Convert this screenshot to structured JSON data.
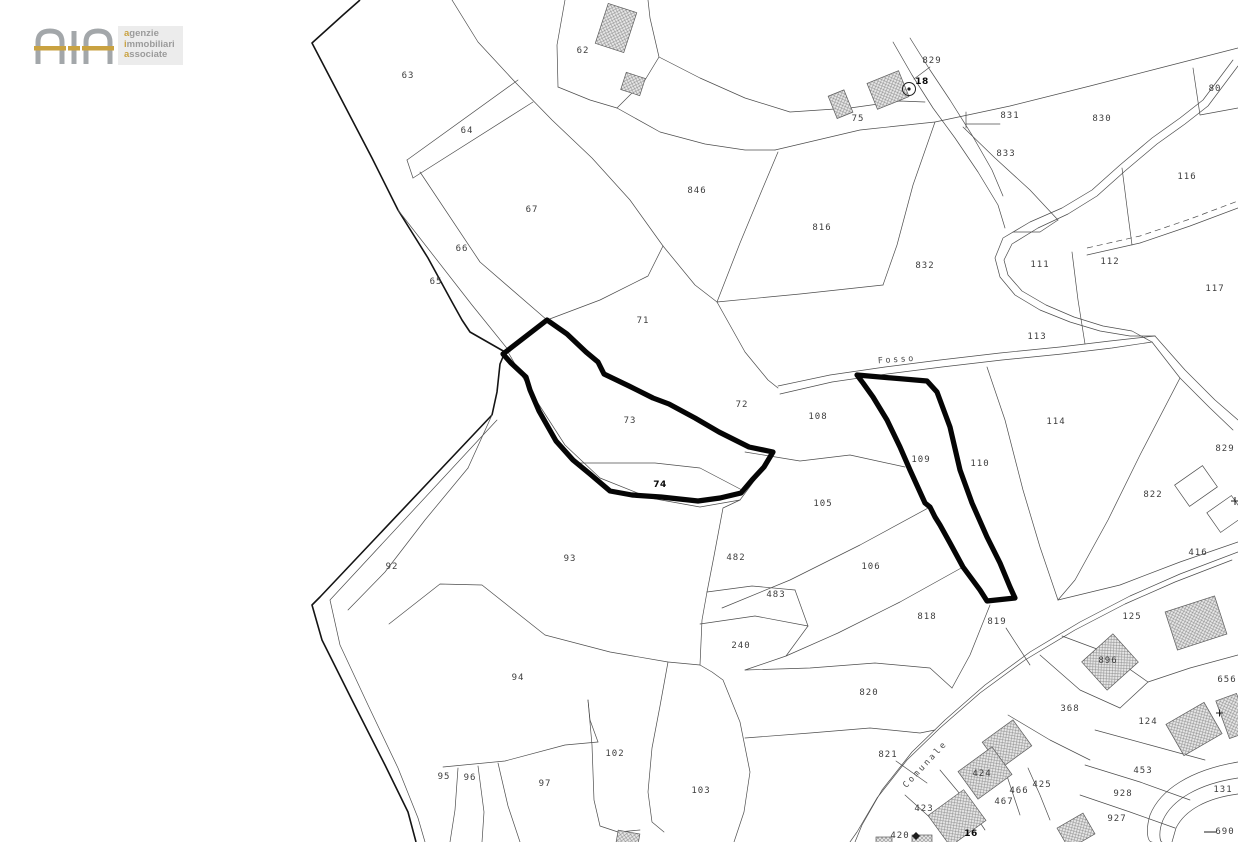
{
  "logo": {
    "mark_letters": "AIA",
    "words": [
      "agenzie",
      "immobiliari",
      "associate"
    ],
    "gold": "#c9a241",
    "gray": "#9b9b9b"
  },
  "map": {
    "background": "#ffffff",
    "line_color": "#4d4d4d",
    "highlight_color": "#050505",
    "highlighted_parcels": [
      "73-74",
      "109"
    ],
    "labels": [
      {
        "t": "62",
        "x": 583,
        "y": 53
      },
      {
        "t": "63",
        "x": 408,
        "y": 78
      },
      {
        "t": "64",
        "x": 467,
        "y": 133
      },
      {
        "t": "67",
        "x": 532,
        "y": 212
      },
      {
        "t": "66",
        "x": 462,
        "y": 251
      },
      {
        "t": "65",
        "x": 436,
        "y": 284
      },
      {
        "t": "846",
        "x": 697,
        "y": 193
      },
      {
        "t": "816",
        "x": 822,
        "y": 230
      },
      {
        "t": "832",
        "x": 925,
        "y": 268
      },
      {
        "t": "75",
        "x": 858,
        "y": 121
      },
      {
        "t": "829",
        "x": 932,
        "y": 63
      },
      {
        "t": "18",
        "x": 922,
        "y": 84,
        "b": 1,
        "s": 12
      },
      {
        "t": "831",
        "x": 1010,
        "y": 118
      },
      {
        "t": "830",
        "x": 1102,
        "y": 121
      },
      {
        "t": "80",
        "x": 1215,
        "y": 91
      },
      {
        "t": "833",
        "x": 1006,
        "y": 156
      },
      {
        "t": "116",
        "x": 1187,
        "y": 179
      },
      {
        "t": "111",
        "x": 1040,
        "y": 267
      },
      {
        "t": "112",
        "x": 1110,
        "y": 264
      },
      {
        "t": "117",
        "x": 1215,
        "y": 291
      },
      {
        "t": "113",
        "x": 1037,
        "y": 339
      },
      {
        "t": "114",
        "x": 1056,
        "y": 424
      },
      {
        "t": "71",
        "x": 643,
        "y": 323
      },
      {
        "t": "72",
        "x": 742,
        "y": 407
      },
      {
        "t": "73",
        "x": 630,
        "y": 423
      },
      {
        "t": "74",
        "x": 660,
        "y": 487,
        "b": 1,
        "s": 14
      },
      {
        "t": "108",
        "x": 818,
        "y": 419
      },
      {
        "t": "109",
        "x": 921,
        "y": 462
      },
      {
        "t": "110",
        "x": 980,
        "y": 466
      },
      {
        "t": "105",
        "x": 823,
        "y": 506
      },
      {
        "t": "106",
        "x": 871,
        "y": 569
      },
      {
        "t": "482",
        "x": 736,
        "y": 560
      },
      {
        "t": "483",
        "x": 776,
        "y": 597
      },
      {
        "t": "240",
        "x": 741,
        "y": 648
      },
      {
        "t": "93",
        "x": 570,
        "y": 561
      },
      {
        "t": "92",
        "x": 392,
        "y": 569
      },
      {
        "t": "94",
        "x": 518,
        "y": 680
      },
      {
        "t": "95",
        "x": 444,
        "y": 779
      },
      {
        "t": "96",
        "x": 470,
        "y": 780
      },
      {
        "t": "97",
        "x": 545,
        "y": 786
      },
      {
        "t": "102",
        "x": 615,
        "y": 756
      },
      {
        "t": "103",
        "x": 701,
        "y": 793
      },
      {
        "t": "818",
        "x": 927,
        "y": 619
      },
      {
        "t": "819",
        "x": 997,
        "y": 624
      },
      {
        "t": "820",
        "x": 869,
        "y": 695
      },
      {
        "t": "821",
        "x": 888,
        "y": 757
      },
      {
        "t": "822",
        "x": 1153,
        "y": 497
      },
      {
        "t": "829",
        "x": 1225,
        "y": 451
      },
      {
        "t": "416",
        "x": 1198,
        "y": 555
      },
      {
        "t": "125",
        "x": 1132,
        "y": 619
      },
      {
        "t": "896",
        "x": 1108,
        "y": 663
      },
      {
        "t": "368",
        "x": 1070,
        "y": 711
      },
      {
        "t": "124",
        "x": 1148,
        "y": 724
      },
      {
        "t": "656",
        "x": 1227,
        "y": 682
      },
      {
        "t": "453",
        "x": 1143,
        "y": 773
      },
      {
        "t": "928",
        "x": 1123,
        "y": 796
      },
      {
        "t": "927",
        "x": 1117,
        "y": 821
      },
      {
        "t": "131",
        "x": 1223,
        "y": 792
      },
      {
        "t": "690",
        "x": 1225,
        "y": 834
      },
      {
        "t": "424",
        "x": 982,
        "y": 776
      },
      {
        "t": "425",
        "x": 1042,
        "y": 787
      },
      {
        "t": "466",
        "x": 1019,
        "y": 793
      },
      {
        "t": "467",
        "x": 1004,
        "y": 804
      },
      {
        "t": "423",
        "x": 924,
        "y": 811
      },
      {
        "t": "420",
        "x": 900,
        "y": 838
      },
      {
        "t": "16",
        "x": 971,
        "y": 836,
        "b": 1,
        "s": 13
      },
      {
        "t": "Fosso",
        "x": 897,
        "y": 362,
        "kind": "road",
        "r": -4
      },
      {
        "t": "Comunale",
        "x": 927,
        "y": 766,
        "kind": "road",
        "r": -47
      }
    ]
  }
}
